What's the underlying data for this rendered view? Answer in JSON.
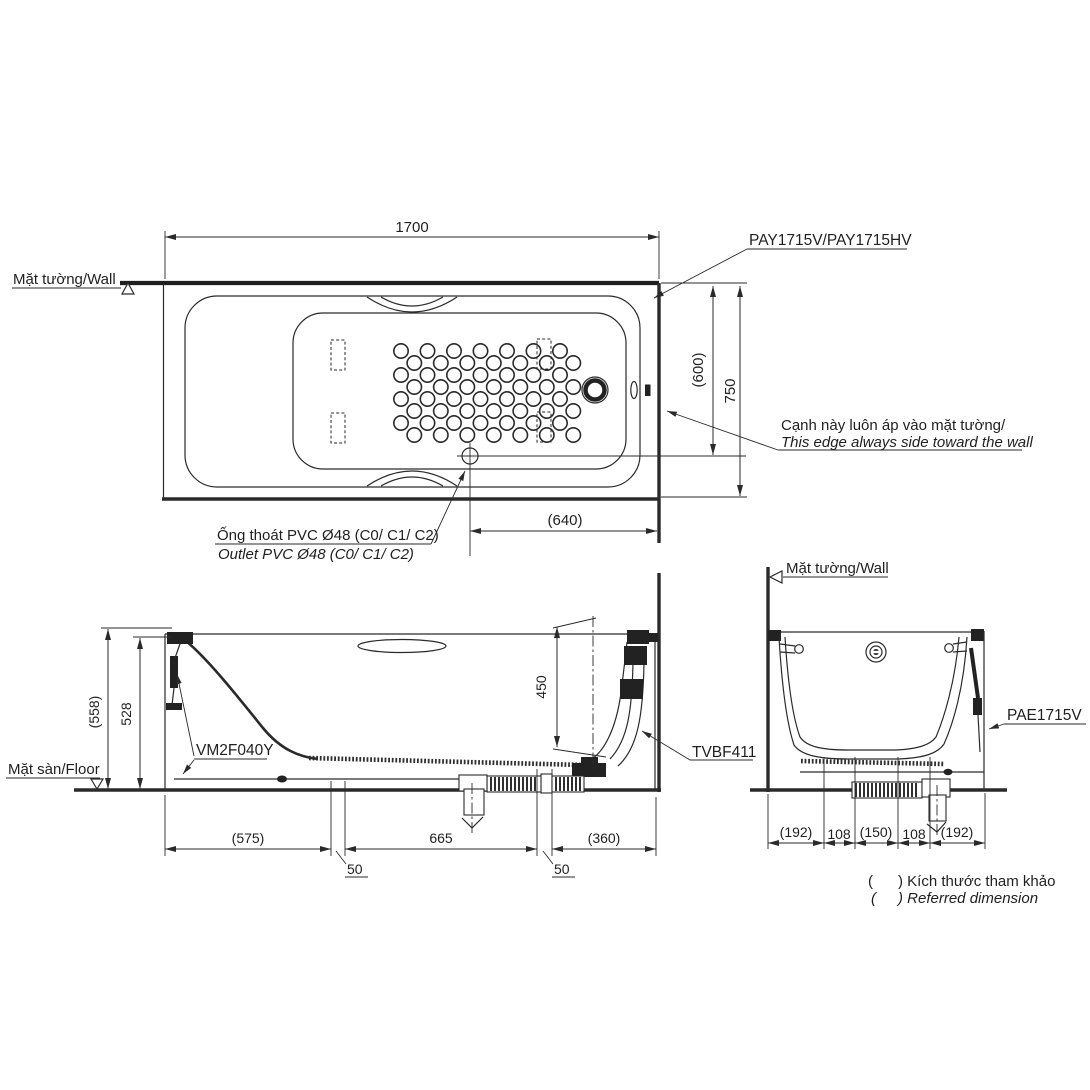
{
  "title_models": {
    "tub": "PAY1715V/PAY1715HV",
    "apron": "PAE1715V",
    "legs": "VM2F040Y",
    "waste_kit": "TVBF411"
  },
  "annotations": {
    "wall_plan": "Mặt tường/Wall",
    "wall_end": "Mặt tường/Wall",
    "floor": "Mặt sàn/Floor",
    "edge_vi": "Cạnh này luôn áp vào mặt tường/",
    "edge_en": "This edge always side toward the wall",
    "outlet_vi": "Ống thoát PVC Ø48 (C0/ C1/ C2)",
    "outlet_en": "Outlet PVC Ø48 (C0/ C1/ C2)",
    "paren": "(",
    "ref_vi": ") Kích thước tham khảo",
    "ref_en": ") Referred dimension"
  },
  "dimensions": {
    "length": "1700",
    "width": "750",
    "width_ref": "(600)",
    "outlet_from_wall": "(640)",
    "overall_height_ref": "(558)",
    "rim_height": "528",
    "depth": "450",
    "base_left_ref": "(575)",
    "base_mid": "665",
    "base_right_ref": "(360)",
    "gap1": "50",
    "gap2": "50",
    "end_a": "(192)",
    "end_b": "108",
    "end_c": "(150)",
    "end_d": "108",
    "end_e": "(192)"
  },
  "colors": {
    "line": "#2a2a2a",
    "background": "#ffffff"
  }
}
